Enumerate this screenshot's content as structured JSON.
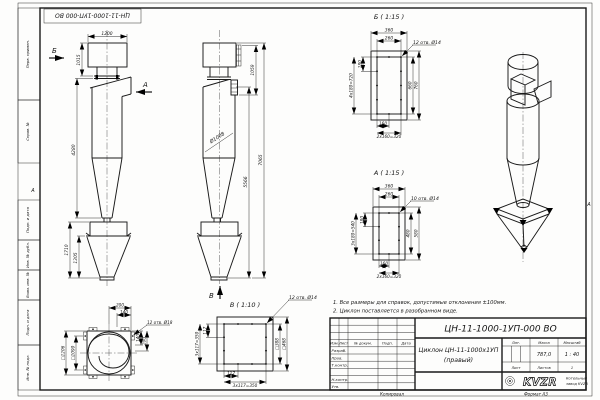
{
  "sheet": {
    "stamp": "ЦН-11-1000-1УП-000 ВО",
    "margin_labels": [
      "Перв. примен.",
      "Справ. №",
      "Подп. и дата",
      "Инв. № дубл.",
      "Взам. инв. №",
      "Подп. и дата",
      "Инв. № подл."
    ],
    "zone_marker": "А",
    "footer_left": "Копировал",
    "footer_right": "Формат А3"
  },
  "notes": {
    "line1": "1. Все размеры для справок, допустимые отклонения ±100мм.",
    "line2": "2. Циклон поставляется в разобранном виде."
  },
  "views": {
    "front": {
      "label_b": "Б",
      "label_a": "А",
      "dim_width": "1200",
      "dim_box_h": "1015",
      "dim_body_h": "4280",
      "dim_bunker_h": "1710",
      "dim_cone_h": "1305"
    },
    "side": {
      "label_v": "В",
      "dim_inlet_h": "1059",
      "dim_dia": "Ø1008",
      "dim_upper_h": "5566",
      "dim_total_h": "7065"
    },
    "detail_b": {
      "title": "Б ( 1:15 )",
      "holes": "12 отв. Ø14",
      "top_outer": "360",
      "top_inner": "260",
      "left_step": "180",
      "left_total": "4x180=720",
      "right_inner": "660",
      "right_outer": "760",
      "bot_step": "160",
      "bot_total": "2x160=320"
    },
    "detail_a": {
      "title": "А ( 1:15 )",
      "holes": "10 отв. Ø14",
      "top_outer": "360",
      "top_inner": "260",
      "left_step": "180",
      "left_total": "3x180=540",
      "right_inner": "480",
      "right_outer": "580",
      "bot_step": "160",
      "bot_total": "2x160=320"
    },
    "detail_v": {
      "title": "В ( 1:10 )",
      "holes": "12 отв. Ø14",
      "left_step": "117",
      "left_total": "3x117=350",
      "right_inner": "□388",
      "right_outer": "□468",
      "bot_step": "117",
      "bot_total": "3x117=350"
    },
    "plan": {
      "holes": "12 отв. Ø18",
      "top_offset": "200",
      "top_offset2": "140",
      "right_offset": "140",
      "right_offset2": "200",
      "sq_outer": "□1206",
      "sq_inner": "□1090"
    }
  },
  "title_block": {
    "doc_number": "ЦН-11-1000-1УП-000 ВО",
    "name_line1": "Циклон ЦН-11-1000х1УП",
    "name_line2": "(правый)",
    "lit_label": "Лит.",
    "mass_label": "Масса",
    "scale_label": "Масштаб",
    "mass_value": "787,0",
    "scale_value": "1 : 40",
    "sheet_label": "Лист",
    "sheets_label": "Листов",
    "sheets_value": "1",
    "header_cols": {
      "izm": "Изм.",
      "list": "Лист",
      "doc": "№ докум.",
      "sign": "Подп.",
      "date": "Дата"
    },
    "roles": {
      "r1": "Разраб.",
      "r2": "Пров.",
      "r3": "Т.контр.",
      "r4": "Н.контр.",
      "r5": "Утв."
    },
    "company_logo": "KVZR",
    "company_line1": "Котельный",
    "company_line2": "завод KVZR"
  }
}
